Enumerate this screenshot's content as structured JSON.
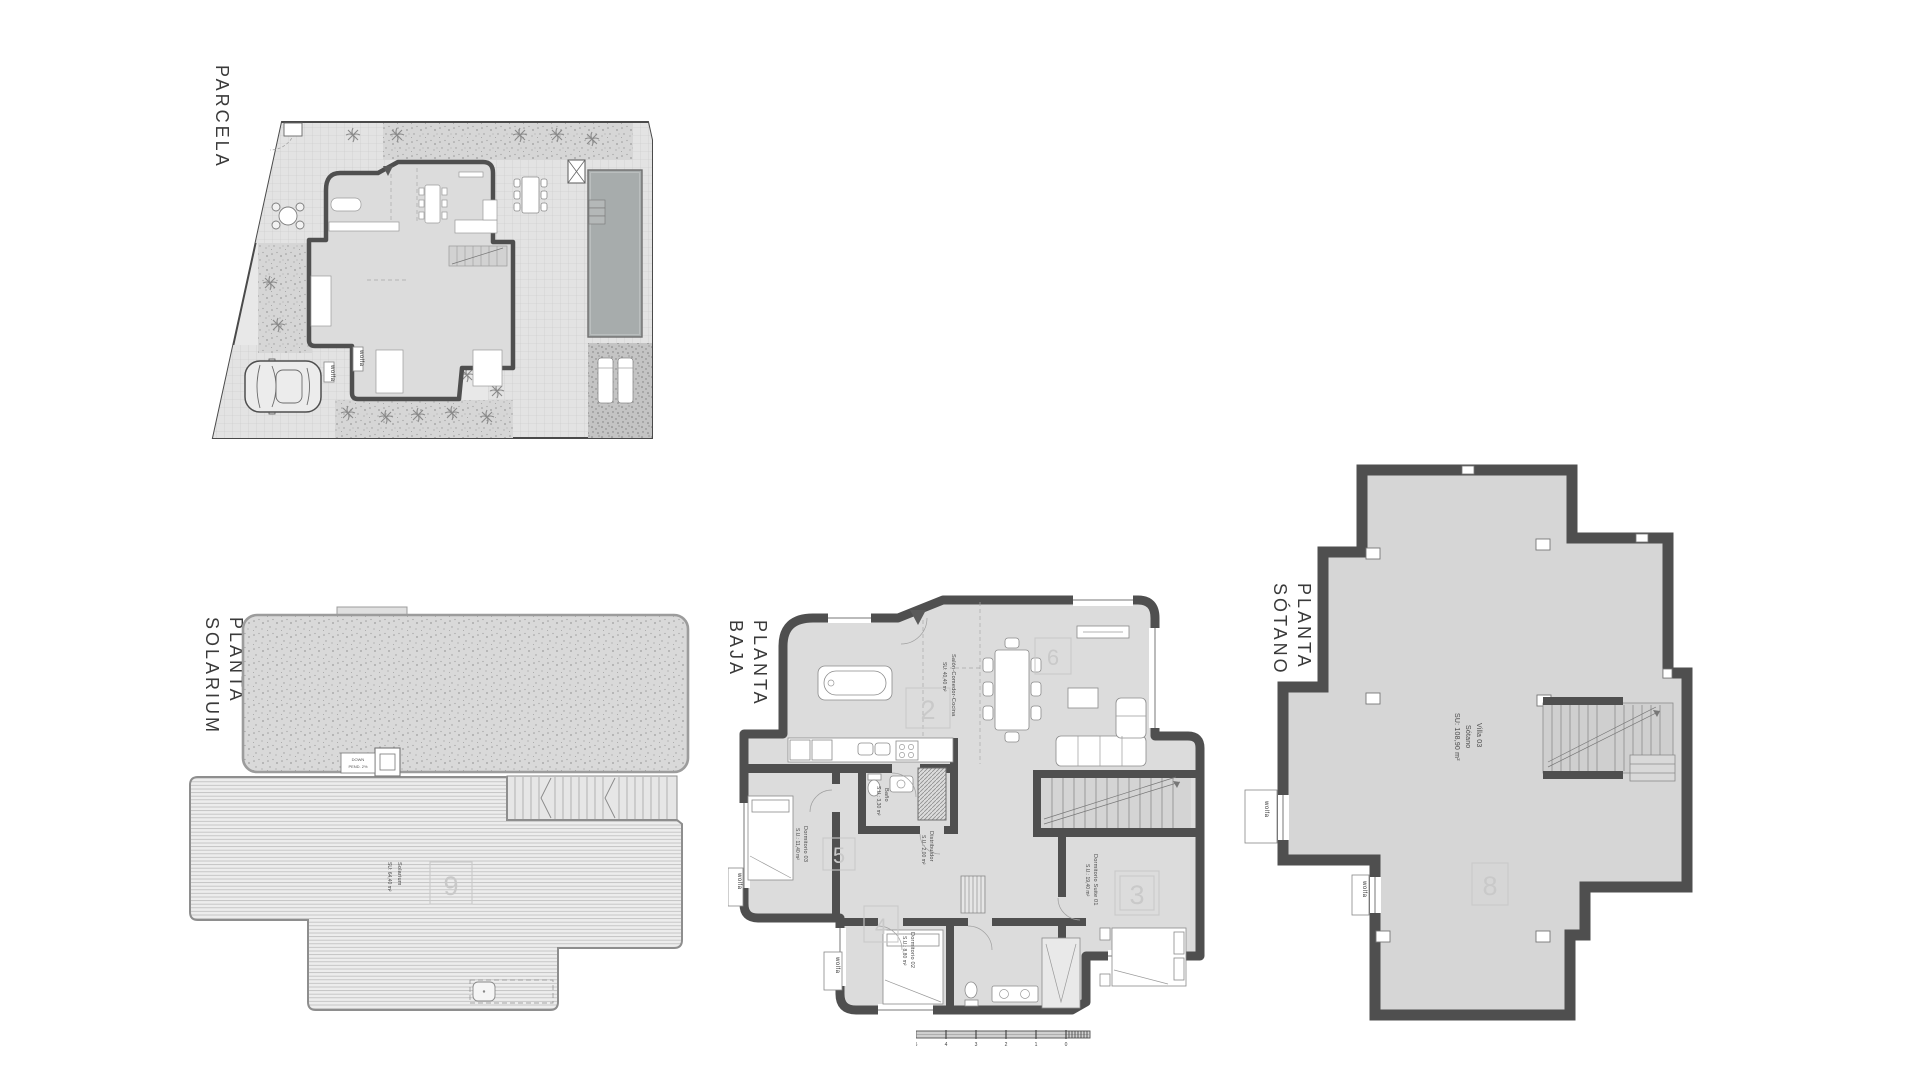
{
  "colors": {
    "wall": "#4f4f4f",
    "floor": "#dcdcdc",
    "floor_sotano": "#d6d6d6",
    "pool": "#a7acac",
    "watermark": "#c9c9c9",
    "label": "#3f3f3f"
  },
  "window_brand": "wolfa",
  "plans": {
    "parcela": {
      "title": "PARCELA"
    },
    "solarium": {
      "title_lines": [
        "PLANTA",
        "SOLARIUM"
      ],
      "room": {
        "name": "Solarium",
        "area": "SU: 64,40 m²"
      },
      "watermark": "9",
      "roof_note_lines": [
        "DOWN",
        "PEND. 2%"
      ]
    },
    "baja": {
      "title_lines": [
        "PLANTA",
        "BAJA"
      ],
      "rooms": [
        {
          "name": "Salón-Comedor-Cocina",
          "area": "SU: 40,40 m²"
        },
        {
          "name": "Baño",
          "area": "S.U.: 3,30 m²"
        },
        {
          "name": "Distribuidor",
          "area": "S.U.: 2,00 m²"
        },
        {
          "name": "Dormitorio 03",
          "area": "S.U.: 11,40 m²"
        },
        {
          "name": "Dormitorio 02",
          "area": "S.U.: 8,80 m²"
        },
        {
          "name": "Dormitorio Suite 01",
          "area": "S.U.: 19,40 m²"
        }
      ],
      "watermarks": {
        "salon": "2",
        "living": "6",
        "dorm03": "5",
        "dorm02": "4",
        "suite": "3"
      }
    },
    "sotano": {
      "title_lines": [
        "PLANTA",
        "SÓTANO"
      ],
      "center_label": [
        "Villa 03",
        "Sótano",
        "SU: 108,90 m²"
      ],
      "watermark": "8"
    }
  },
  "scale_bar": {
    "labels": [
      "5",
      "4",
      "3",
      "2",
      "1",
      "0"
    ]
  }
}
